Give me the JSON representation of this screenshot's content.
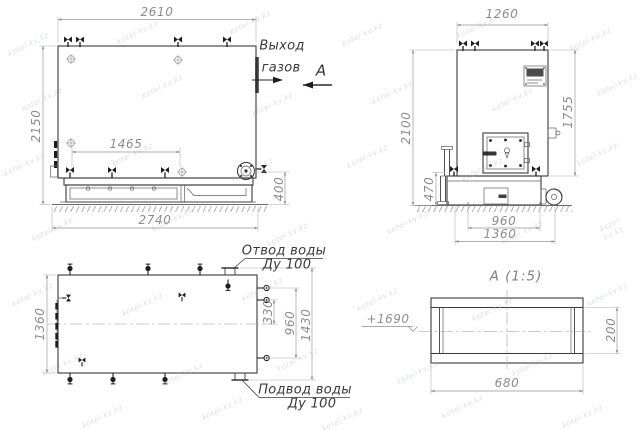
{
  "watermark": {
    "text": "kotel-kv.kz"
  },
  "views": {
    "side": {
      "dim_width_top": "2610",
      "dim_height_left": "2150",
      "dim_grate_length": "1465",
      "dim_length_bottom": "2740",
      "dim_base_height": "400",
      "gas_outlet_label_line1": "Выход",
      "gas_outlet_label_line2": "газов",
      "section_mark": "А"
    },
    "front": {
      "dim_width_top": "1260",
      "dim_height_left": "2100",
      "dim_body_height_right": "1755",
      "dim_base_height": "470",
      "dim_base_inner_width": "960",
      "dim_base_outer_width": "1360"
    },
    "top": {
      "dim_width_left": "1360",
      "dim_nozzle_offset": "330",
      "dim_nozzle_span": "960",
      "dim_flange_span": "1430",
      "water_outlet_label_line1": "Отвод воды",
      "water_outlet_label_line2": "Ду 100",
      "water_inlet_label_line1": "Подвод воды",
      "water_inlet_label_line2": "Ду 100"
    },
    "section_a": {
      "title": "А (1:5)",
      "elevation_mark": "+1690",
      "dim_height": "200",
      "dim_width": "680"
    }
  }
}
